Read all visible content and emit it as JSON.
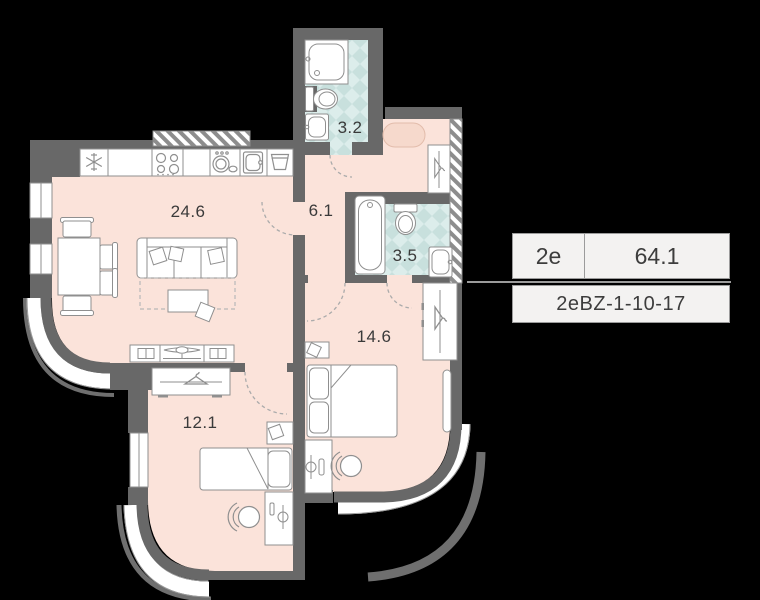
{
  "unit_card": {
    "rooms_label": "2e",
    "area_value": "64.1",
    "unit_code": "2eBZ-1-10-17"
  },
  "rooms": [
    {
      "name": "kitchen-living-room",
      "area": "24.6"
    },
    {
      "name": "hallway",
      "area": "6.1"
    },
    {
      "name": "bathroom",
      "area": "3.2"
    },
    {
      "name": "ensuite-bathroom",
      "area": "3.5"
    },
    {
      "name": "master-bedroom",
      "area": "14.6"
    },
    {
      "name": "second-bedroom",
      "area": "12.1"
    }
  ],
  "icons": [
    "fridge-snowflake-icon",
    "stove-burners-icon",
    "dishwasher-icon",
    "kitchen-sink-icon",
    "laundry-basin-icon",
    "hanger-icon",
    "open-book-icon",
    "tv-icon",
    "lamp-icon"
  ],
  "colors": {
    "background": "#000000",
    "wall": "#686868",
    "floor": "#fbe3da",
    "tile": "#dcedeb",
    "tile_alt": "#c8e0dd",
    "card_background": "#f3f2f1",
    "card_border": "#9b9b9b",
    "label_text": "#3a3a3a"
  }
}
